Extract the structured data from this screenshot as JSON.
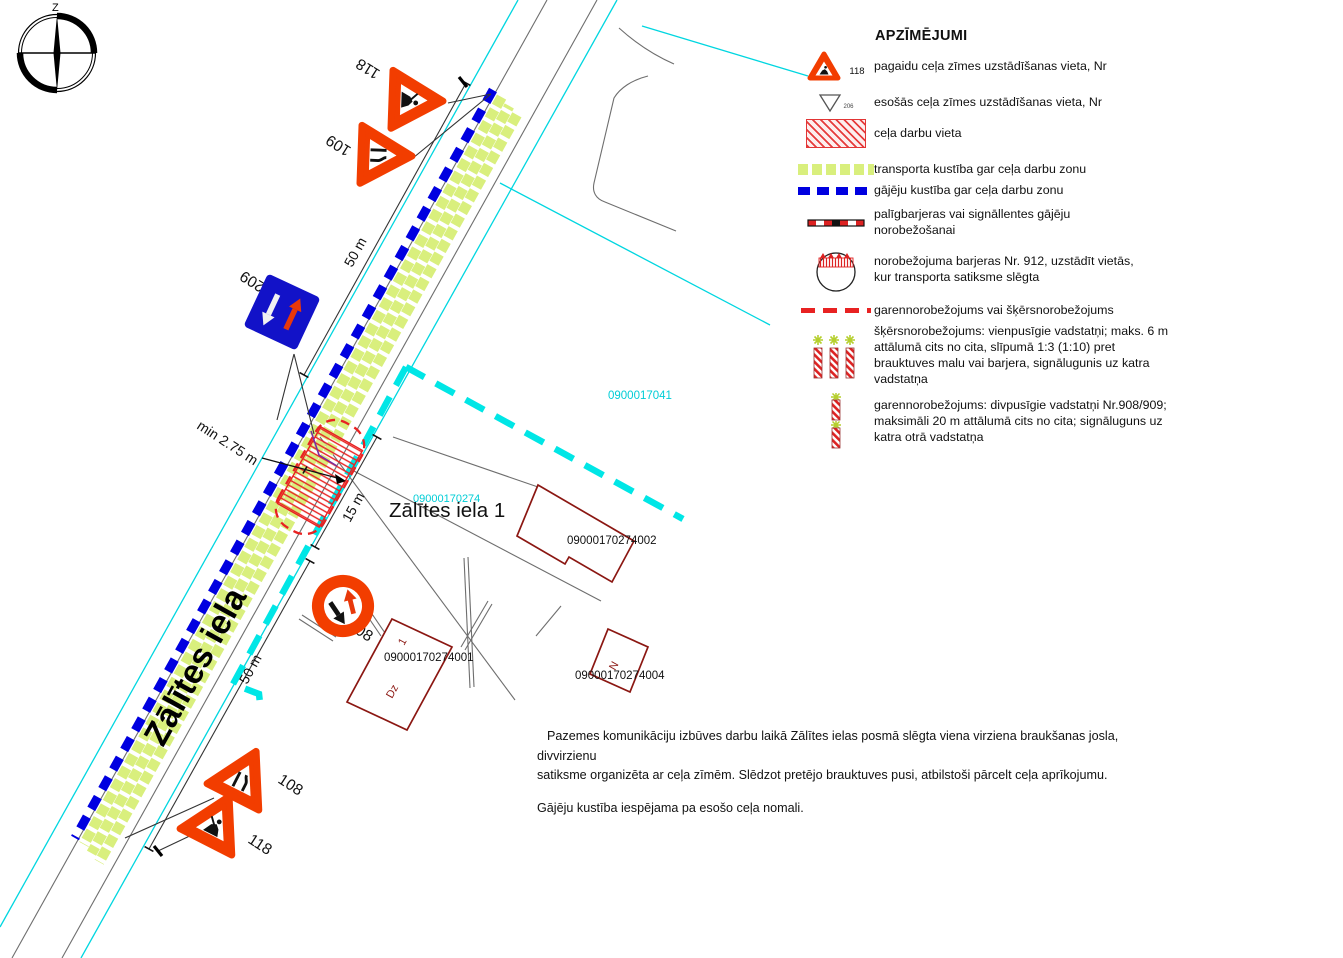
{
  "legend": {
    "title": "APZĪMĒJUMI",
    "items": [
      {
        "id": "temp-road-sign",
        "sign_number": "118",
        "label": "pagaidu ceļa zīmes uzstādīšanas vieta, Nr"
      },
      {
        "id": "existing-road-sign",
        "sign_number": "206",
        "label": "esošās ceļa zīmes uzstādīšanas vieta, Nr"
      },
      {
        "id": "road-works-area",
        "label": "ceļa darbu vieta"
      },
      {
        "id": "transport-route",
        "label": "transporta kustība gar ceļa darbu zonu"
      },
      {
        "id": "pedestrian-route",
        "label": "gājēju kustība gar ceļa darbu zonu"
      },
      {
        "id": "aux-barriers",
        "label": "palīgbarjeras vai signāllentes gājēju\nnorobežošanai"
      },
      {
        "id": "barrier-912",
        "label": "norobežojuma barjeras Nr. 912, uzstādīt vietās,\nkur transporta satiksme slēgta"
      },
      {
        "id": "longitudinal-or-cross-barrier",
        "label": "garennorobežojums vai šķērsnorobežojums"
      },
      {
        "id": "cross-barrier-posts",
        "label": "šķērsnorobežojums: vienpusīgie vadstatņi; maks. 6 m\nattālumā cits no cita, slīpumā 1:3 (1:10) pret\nbrauktuves malu vai barjera, signālugunis uz katra\nvadstatņa"
      },
      {
        "id": "longitudinal-posts",
        "label": "garennorobežojums: divpusīgie vadstatņi Nr.908/909;\nmaksimāli 20 m attālumā cits no cita; signāluguns uz\nkatra otrā vadstatņa"
      }
    ]
  },
  "map": {
    "compass_label": "Z",
    "street_name": "Zālītes iela",
    "address_label": "Zālītes iela 1",
    "parcels": {
      "p1": "0900017041",
      "p2": "09000170274",
      "b1": "09000170274001",
      "b2": "09000170274002",
      "b4": "09000170274004"
    },
    "building_marks": {
      "b1_no": "1",
      "b1_type": "Dz",
      "b4_type": "N"
    },
    "signs": {
      "top_118": "118",
      "top_109": "109",
      "s209": "209",
      "s208": "208",
      "s108": "108",
      "bottom_118": "118"
    },
    "dims": {
      "top_50": "50 m",
      "min_width": "min 2.75 m",
      "len_15": "15 m",
      "bottom_50": "50 m"
    }
  },
  "notes": {
    "para1": "Pazemes komunikāciju izbūves darbu laikā Zālītes ielas posmā slēgta viena virziena braukšanas josla, divvirzienu\nsatiksme organizēta ar ceļa zīmēm. Slēdzot pretējo brauktuves pusi, atbilstoši pārcelt ceļa aprīkojumu.",
    "para2": "Gājēju kustība iespējama pa esošo ceļa nomali."
  },
  "colors": {
    "sign_red": "#f23d00",
    "sign_blue": "#1212c8",
    "dash_blue": "#0000e0",
    "band_green": "#d9ef7d",
    "cyan": "#00e2e8",
    "building": "#8b1712",
    "hatch_red": "#e82222"
  }
}
